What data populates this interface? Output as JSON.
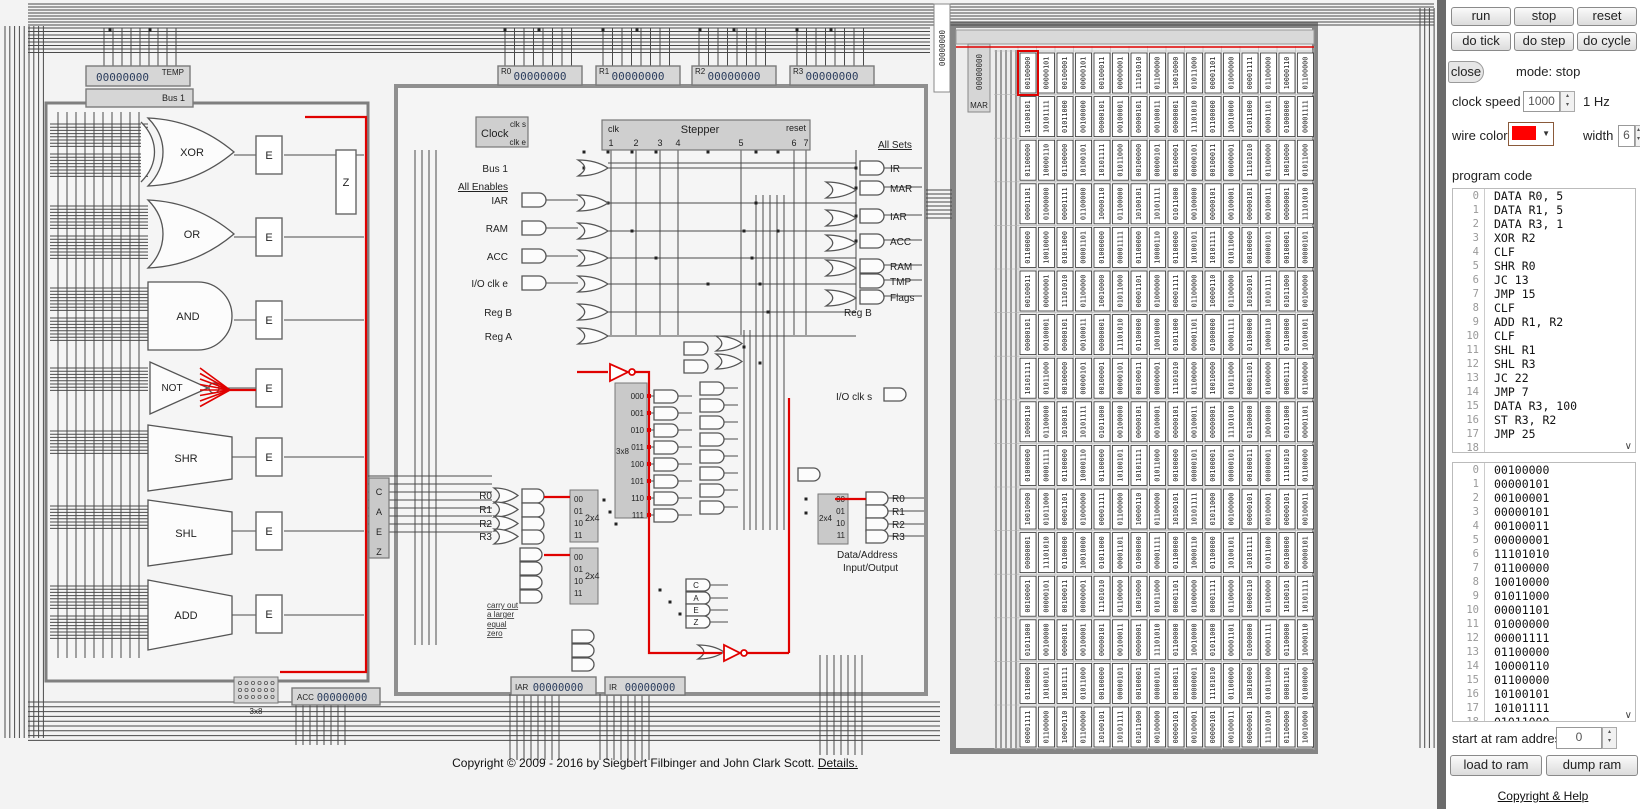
{
  "panel": {
    "buttons_row1": [
      "run",
      "stop",
      "reset"
    ],
    "buttons_row2": [
      "do tick",
      "do step",
      "do cycle"
    ],
    "close_label": "close",
    "mode_text": "mode: stop",
    "clock_speed": {
      "label": "clock speed",
      "value": "1000",
      "unit": "1 Hz"
    },
    "wire": {
      "color_label": "wire color",
      "color": "#ff0000",
      "width_label": "width",
      "width_value": "6"
    },
    "program_code_label": "program code",
    "program": [
      {
        "n": "0",
        "text": "DATA R0, 5"
      },
      {
        "n": "1",
        "text": "DATA R1, 5"
      },
      {
        "n": "2",
        "text": "DATA R3, 1"
      },
      {
        "n": "3",
        "text": "XOR R2"
      },
      {
        "n": "4",
        "text": "CLF"
      },
      {
        "n": "5",
        "text": "SHR R0"
      },
      {
        "n": "6",
        "text": "JC 13"
      },
      {
        "n": "7",
        "text": "JMP 15"
      },
      {
        "n": "8",
        "text": "CLF"
      },
      {
        "n": "9",
        "text": "ADD R1, R2"
      },
      {
        "n": "10",
        "text": "CLF"
      },
      {
        "n": "11",
        "text": "SHL R1"
      },
      {
        "n": "12",
        "text": "SHL R3"
      },
      {
        "n": "13",
        "text": "JC 22"
      },
      {
        "n": "14",
        "text": "JMP 7"
      },
      {
        "n": "15",
        "text": "DATA R3, 100"
      },
      {
        "n": "16",
        "text": "ST R3, R2"
      },
      {
        "n": "17",
        "text": "JMP 25"
      },
      {
        "n": "18",
        "text": ""
      }
    ],
    "ram_list": [
      {
        "n": "0",
        "v": "00100000"
      },
      {
        "n": "1",
        "v": "00000101"
      },
      {
        "n": "2",
        "v": "00100001"
      },
      {
        "n": "3",
        "v": "00000101"
      },
      {
        "n": "4",
        "v": "00100011"
      },
      {
        "n": "5",
        "v": "00000001"
      },
      {
        "n": "6",
        "v": "11101010"
      },
      {
        "n": "7",
        "v": "01100000"
      },
      {
        "n": "8",
        "v": "10010000"
      },
      {
        "n": "9",
        "v": "01011000"
      },
      {
        "n": "10",
        "v": "00001101"
      },
      {
        "n": "11",
        "v": "01000000"
      },
      {
        "n": "12",
        "v": "00001111"
      },
      {
        "n": "13",
        "v": "01100000"
      },
      {
        "n": "14",
        "v": "10000110"
      },
      {
        "n": "15",
        "v": "01100000"
      },
      {
        "n": "16",
        "v": "10100101"
      },
      {
        "n": "17",
        "v": "10101111"
      },
      {
        "n": "18",
        "v": "01011000"
      }
    ],
    "start_at": {
      "label": "start at ram address",
      "value": "0"
    },
    "load_button": "load to ram",
    "dump_button": "dump ram",
    "help_link": "Copyright & Help"
  },
  "registers": {
    "temp": {
      "label": "TEMP",
      "value": "00000000"
    },
    "bus1": {
      "label": "Bus 1"
    },
    "r0": {
      "label": "R0",
      "value": "00000000"
    },
    "r1": {
      "label": "R1",
      "value": "00000000"
    },
    "r2": {
      "label": "R2",
      "value": "00000000"
    },
    "r3": {
      "label": "R3",
      "value": "00000000"
    },
    "bus_col": {
      "value": "00000000"
    },
    "mar": {
      "label": "MAR",
      "value": "00000000"
    },
    "iar": {
      "label": "IAR",
      "value": "00000000"
    },
    "ir": {
      "label": "IR",
      "value": "00000000"
    },
    "acc": {
      "label": "ACC",
      "value": "00000000"
    }
  },
  "alu": {
    "gates": [
      "XOR",
      "OR",
      "AND",
      "NOT",
      "SHR",
      "SHL",
      "ADD"
    ],
    "enable_label": "E",
    "zero_label": "Z",
    "decoder_label": "3x8",
    "caez": [
      "C",
      "A",
      "E",
      "Z"
    ]
  },
  "control": {
    "clock": {
      "label": "Clock",
      "clk_s": "clk s",
      "clk_e": "clk e"
    },
    "stepper": {
      "label": "Stepper",
      "clk": "clk",
      "reset": "reset",
      "steps": [
        "1",
        "2",
        "3",
        "4",
        "5",
        "6",
        "7"
      ]
    },
    "enables": {
      "header": "All Enables",
      "bus1": "Bus 1",
      "items": [
        "IAR",
        "RAM",
        "ACC",
        "I/O clk e"
      ],
      "reg_b": "Reg B",
      "reg_a": "Reg A"
    },
    "sets": {
      "header": "All Sets",
      "items": [
        "IR",
        "MAR",
        "IAR",
        "ACC",
        "RA M",
        "TMP",
        "Flags"
      ],
      "reg_b": "Reg B",
      "io_clk_s": "I/O clk s"
    },
    "decoder3x8": {
      "label": "3x8",
      "outputs": [
        "000",
        "001",
        "010",
        "011",
        "100",
        "101",
        "110",
        "111"
      ]
    },
    "reg_select": {
      "labels": [
        "R0",
        "R1",
        "R2",
        "R3"
      ],
      "decoder_label": "2x4",
      "codes": [
        "00",
        "01",
        "10",
        "11"
      ]
    },
    "right_decoder": {
      "label": "2x4",
      "codes": [
        "00",
        "01",
        "10",
        "11"
      ],
      "regs": [
        "R0",
        "R1",
        "R2",
        "R3"
      ],
      "caption1": "Data/Address",
      "caption2": "Input/Output"
    },
    "flag_labels": [
      "carry out",
      "a larger",
      "equal",
      "zero"
    ]
  },
  "ram_grid": {
    "rows": 16,
    "cols": 16,
    "values": [
      "00100000",
      "00000101",
      "00100001",
      "00000101",
      "00100011",
      "00000001",
      "11101010",
      "01100000",
      "10010000",
      "01011000",
      "00001101",
      "01000000",
      "00001111",
      "01100000",
      "10000110",
      "01100000",
      "10100101",
      "10101111",
      "01011000",
      "00100000",
      "00000101",
      "00100001",
      "00000101",
      "00100011",
      "00000001",
      "11101010",
      "01100000",
      "10010000",
      "01011000",
      "00001101",
      "01000000",
      "00001111",
      "01100000",
      "10000110",
      "01100000",
      "10100101",
      "10101111",
      "01011000",
      "00100000",
      "00000101",
      "00100001",
      "00000101",
      "00100011",
      "00000001",
      "11101010",
      "01100000",
      "10010000",
      "01011000",
      "00001101",
      "01000000",
      "00001111",
      "01100000",
      "10000110",
      "01100000",
      "10100101",
      "10101111",
      "01011000",
      "00100000",
      "00000101",
      "00100001",
      "00000101",
      "00100011",
      "00000001",
      "11101010",
      "01100000",
      "10010000",
      "01011000",
      "00001101",
      "01000000",
      "00001111",
      "01100000",
      "10000110",
      "01100000",
      "10100101",
      "10101111",
      "01011000",
      "00100000",
      "00000101",
      "00100001",
      "00000101",
      "00100011",
      "00000001",
      "11101010",
      "01100000",
      "10010000",
      "01011000",
      "00001101",
      "01000000",
      "00001111",
      "01100000",
      "10000110",
      "01100000",
      "10100101",
      "10101111",
      "01011000",
      "00100000",
      "00000101",
      "00100001",
      "00000101",
      "00100011",
      "00000001",
      "11101010",
      "01100000",
      "10010000",
      "01011000",
      "00001101",
      "01000000",
      "00001111",
      "01100000",
      "10000110",
      "01100000",
      "10100101",
      "10101111",
      "01011000",
      "00100000",
      "00000101",
      "00100001",
      "00000101",
      "00100011",
      "00000001",
      "11101010",
      "01100000",
      "10010000",
      "01011000",
      "00001101",
      "01000000",
      "00001111",
      "01100000",
      "10000110",
      "01100000",
      "10100101",
      "10101111",
      "01011000",
      "00100000",
      "00000101",
      "00100001",
      "00000101",
      "00100011",
      "00000001",
      "11101010",
      "01100000",
      "10010000",
      "01011000",
      "00001101",
      "01000000",
      "00001111",
      "01100000",
      "10000110",
      "01100000",
      "10100101",
      "10101111",
      "01011000",
      "00100000",
      "00000101",
      "00100001",
      "00000101",
      "00100011",
      "00000001",
      "11101010",
      "01100000",
      "10010000",
      "01011000",
      "00001101",
      "01000000",
      "00001111",
      "01100000",
      "10000110",
      "01100000",
      "10100101",
      "10101111",
      "01011000",
      "00100000",
      "00000101",
      "00100001",
      "00000101",
      "00100011",
      "00000001",
      "11101010",
      "01100000",
      "10010000",
      "01011000",
      "00001101",
      "01000000",
      "00001111",
      "01100000",
      "10000110",
      "01100000",
      "10100101",
      "10101111",
      "01011000",
      "00100000",
      "00000101",
      "00100001",
      "00000101",
      "00100011",
      "00000001",
      "11101010",
      "01100000",
      "10010000",
      "01011000",
      "00001101",
      "01000000",
      "00001111",
      "01100000",
      "10000110",
      "01100000",
      "10100101",
      "10101111",
      "01011000",
      "00100000",
      "00000101",
      "00100001",
      "00000101",
      "00100011",
      "00000001",
      "11101010",
      "01100000",
      "10010000",
      "01011000",
      "00001101",
      "01000000",
      "00001111",
      "01100000",
      "10000110",
      "01100000",
      "10100101",
      "10101111",
      "01011000",
      "00100000",
      "00000101",
      "00100001",
      "00000101",
      "00100011",
      "00000001",
      "11101010",
      "01100000",
      "10010000",
      "01011000",
      "00001101",
      "01000000",
      "00001111",
      "01100000",
      "10000110",
      "01100000",
      "10100101",
      "10101111",
      "01011000",
      "00100000",
      "00000101",
      "00100001",
      "00000101",
      "00100011",
      "00000001",
      "11101010",
      "01100000",
      "10010000"
    ]
  },
  "footer": {
    "copyright": "Copyright © 2009 - 2016 by Siegbert Filbinger and John Clark Scott.",
    "details_link": "Details."
  }
}
